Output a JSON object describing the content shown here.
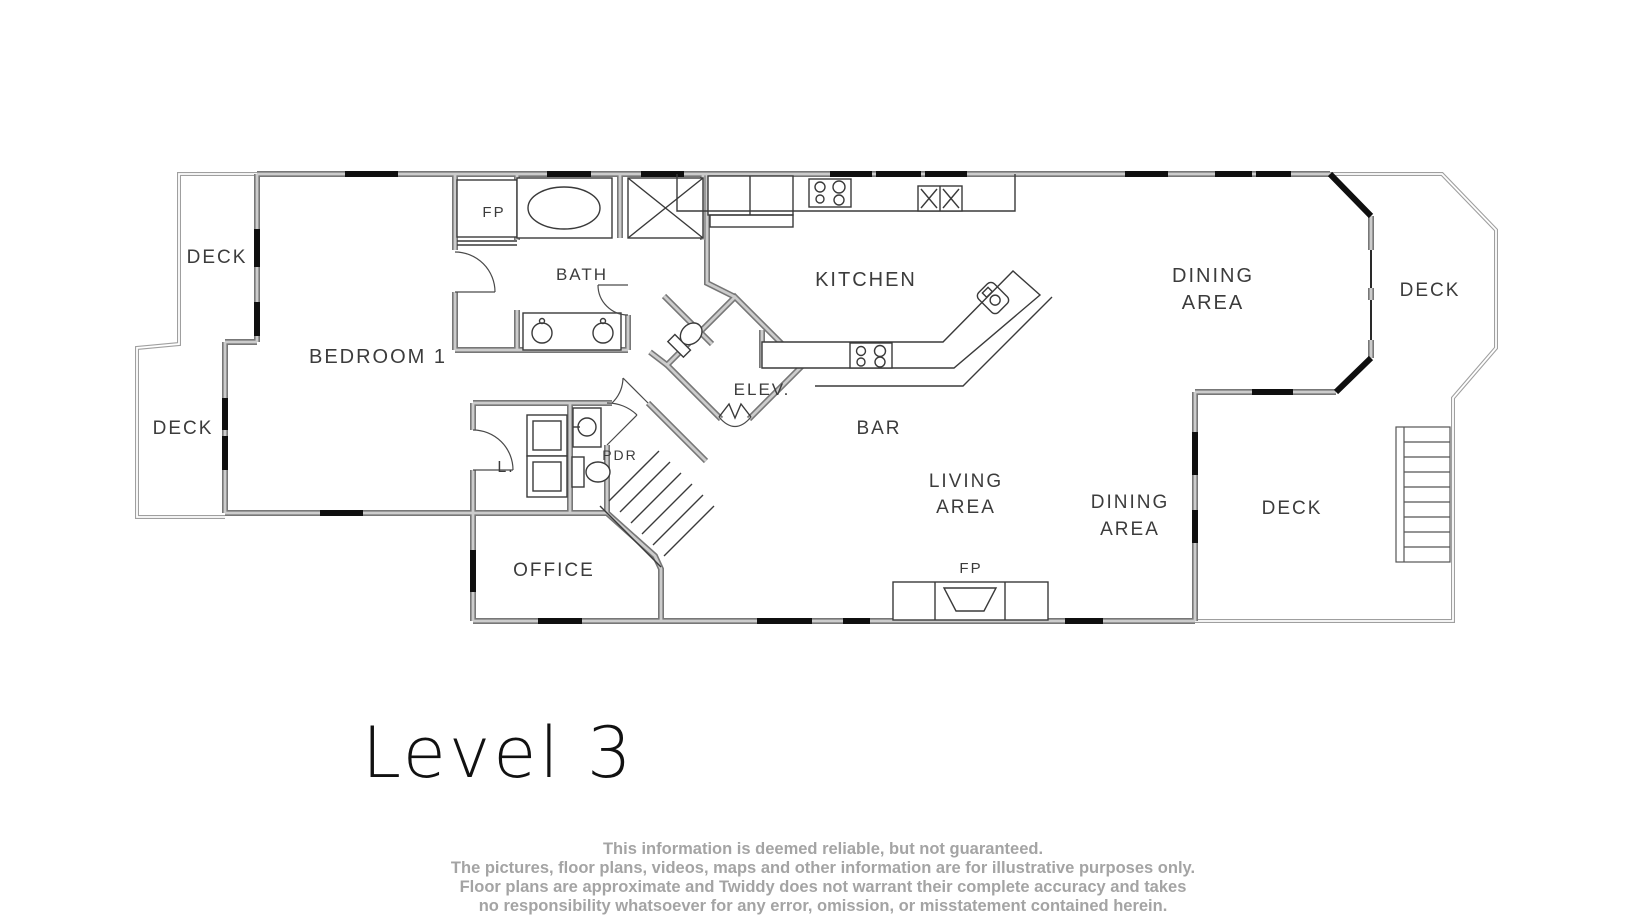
{
  "title": "Level 3",
  "labels": {
    "deck_top_left": "DECK",
    "deck_bottom_left": "DECK",
    "deck_right": "DECK",
    "deck_bottom_right": "DECK",
    "bedroom1": "BEDROOM 1",
    "fp_top": "FP",
    "fp_bottom": "FP",
    "bath": "BATH",
    "kitchen": "KITCHEN",
    "dining_top_line1": "DINING",
    "dining_top_line2": "AREA",
    "dining_bottom_line1": "DINING",
    "dining_bottom_line2": "AREA",
    "living_line1": "LIVING",
    "living_line2": "AREA",
    "elevator": "ELEV.",
    "bar": "BAR",
    "powder": "PDR",
    "laundry": "L.",
    "office": "OFFICE"
  },
  "disclaimer": {
    "line1": "This information is deemed reliable, but not guaranteed.",
    "line2": "The pictures, floor plans, videos, maps and other information are for illustrative purposes only.",
    "line3": "Floor plans are approximate and Twiddy does not warrant their complete accuracy and takes",
    "line4": "no responsibility whatsoever for any error, omission, or misstatement contained herein."
  },
  "colors": {
    "wall": "#777777",
    "wall_core": "#cccccc",
    "window": "#0f0f0f",
    "deck_rail": "#9f9f9f",
    "label_text": "#3c3c3c",
    "disclaimer_text": "#a4a4a4"
  }
}
